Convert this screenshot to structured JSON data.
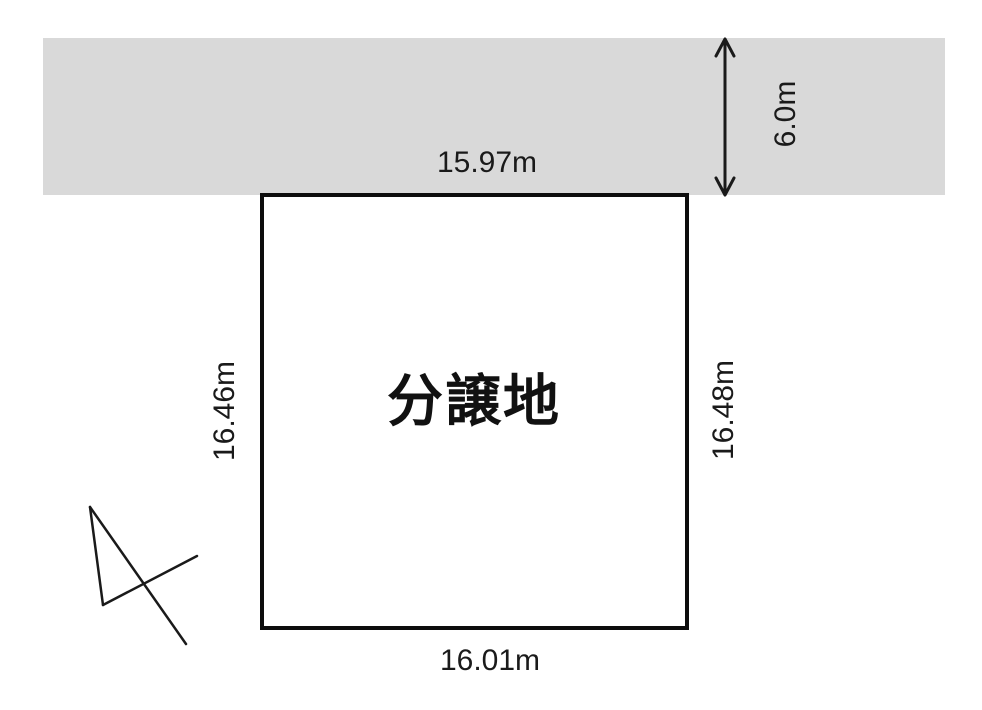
{
  "road": {
    "width_label": "6.0m",
    "fill_color": "#d9d9d9"
  },
  "plot": {
    "name": "分譲地",
    "dim_top": "15.97m",
    "dim_left": "16.46m",
    "dim_right": "16.48m",
    "dim_bottom": "16.01m"
  },
  "colors": {
    "line": "#1a1a1a",
    "plot_border": "#0d0d0d",
    "road_fill": "#d9d9d9",
    "background": "#ffffff"
  },
  "icons": {
    "road_width_arrow": "double-headed-vertical-arrow",
    "north_arrow": "hand-drawn-north-arrow"
  }
}
